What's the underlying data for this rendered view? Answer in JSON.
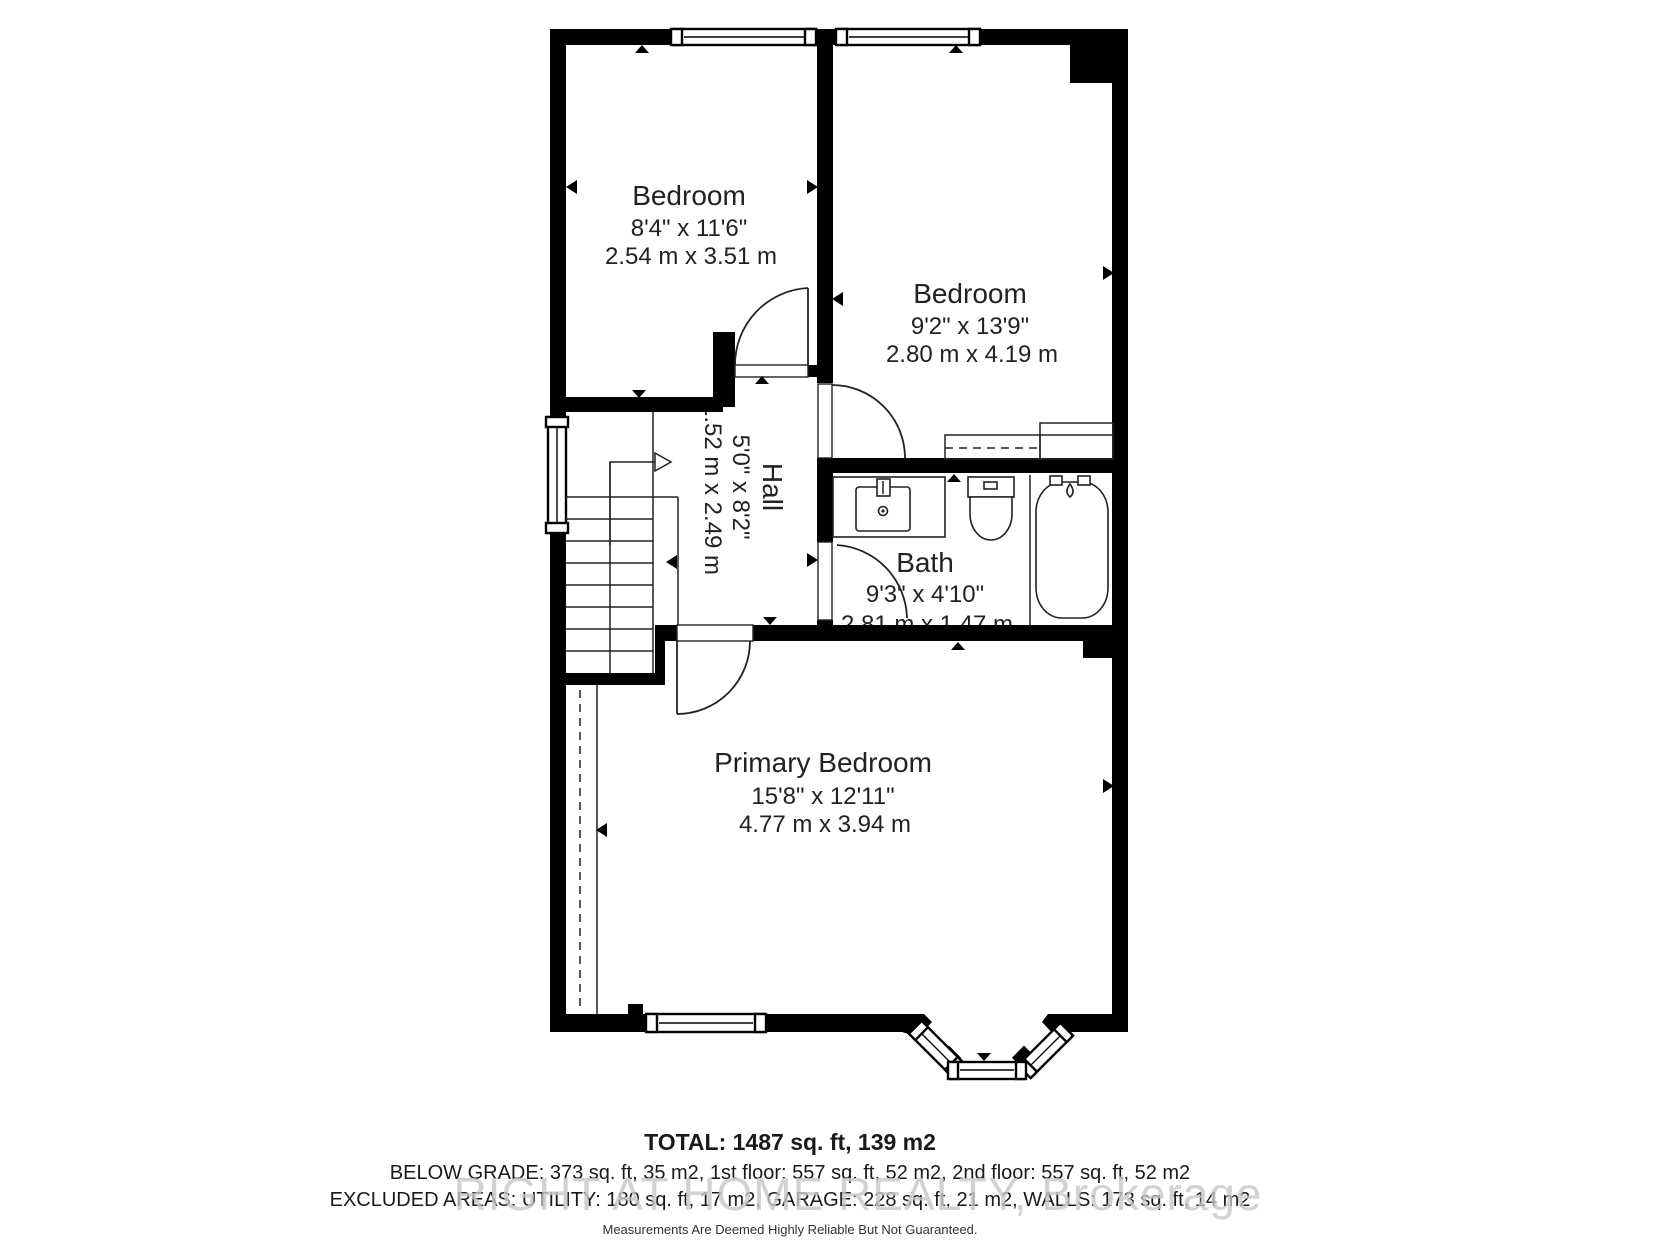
{
  "floorplan": {
    "rooms": [
      {
        "name": "Bedroom",
        "imperial": "8'4\" x 11'6\"",
        "metric": "2.54 m x 3.51 m"
      },
      {
        "name": "Bedroom",
        "imperial": "9'2\" x 13'9\"",
        "metric": "2.80 m x 4.19 m"
      },
      {
        "name": "Hall",
        "imperial": "5'0\" x 8'2\"",
        "metric": "1.52 m x 2.49 m"
      },
      {
        "name": "Bath",
        "imperial": "9'3\" x 4'10\"",
        "metric": "2.81 m x 1.47 m"
      },
      {
        "name": "Primary Bedroom",
        "imperial": "15'8\" x 12'11\"",
        "metric": "4.77 m x 3.94 m"
      }
    ],
    "summary": {
      "total": "TOTAL: 1487 sq. ft, 139 m2",
      "floors": "BELOW GRADE: 373 sq. ft, 35 m2, 1st floor: 557 sq. ft, 52 m2, 2nd floor: 557 sq. ft, 52 m2",
      "excluded": "EXCLUDED AREAS: UTILITY: 180 sq. ft, 17 m2, GARAGE: 228 sq. ft, 21 m2, WALLS: 173 sq. ft, 14 m2",
      "disclaimer": "Measurements Are Deemed Highly Reliable But Not Guaranteed."
    },
    "watermark": "RIGHT AT HOME REALTY, Brokerage",
    "colors": {
      "wall": "#000000",
      "text": "#222222",
      "watermark": "#c8c8c8",
      "background": "#ffffff"
    }
  }
}
